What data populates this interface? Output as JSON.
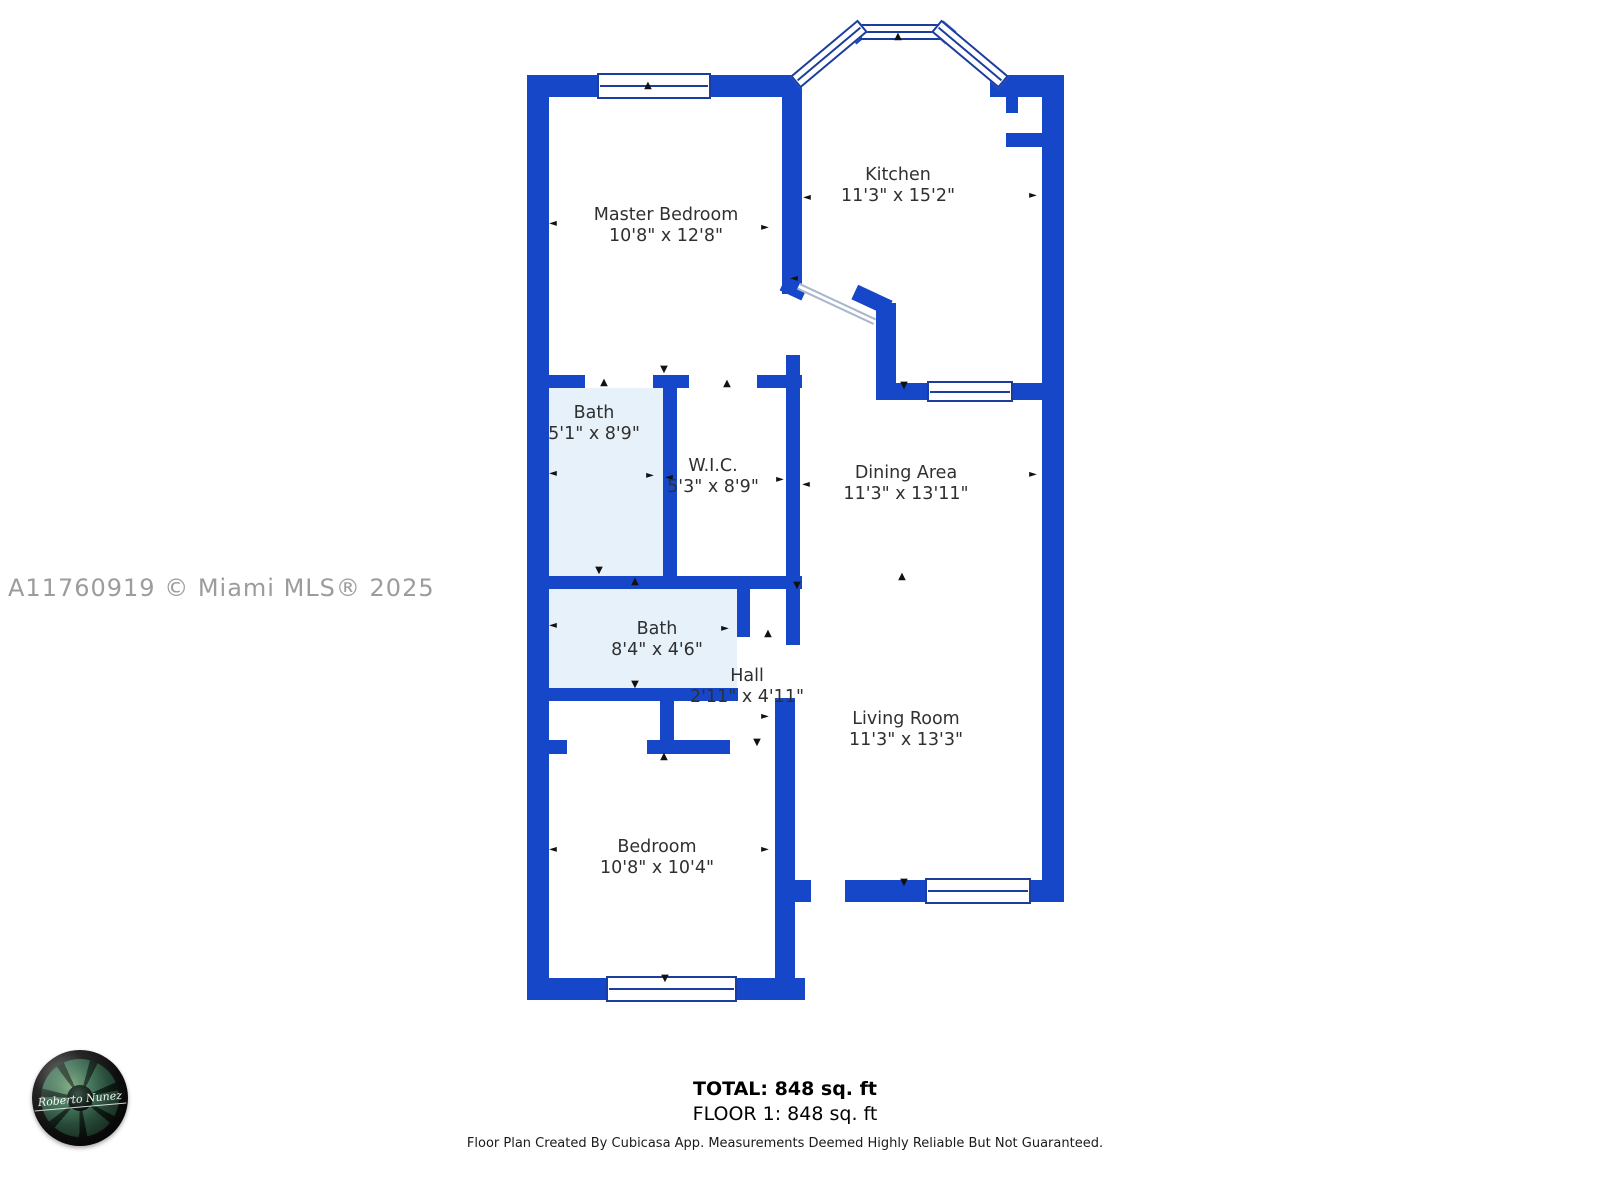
{
  "watermark": "A11760919 © Miami MLS® 2025",
  "rooms": [
    {
      "name": "Master Bedroom",
      "dims": "10'8\" x 12'8\""
    },
    {
      "name": "Kitchen",
      "dims": "11'3\" x 15'2\""
    },
    {
      "name": "Bath",
      "dims": "5'1\" x 8'9\""
    },
    {
      "name": "W.I.C.",
      "dims": "5'3\" x 8'9\""
    },
    {
      "name": "Dining Area",
      "dims": "11'3\" x 13'11\""
    },
    {
      "name": "Bath",
      "dims": "8'4\" x 4'6\""
    },
    {
      "name": "Hall",
      "dims": "2'11\" x 4'11\""
    },
    {
      "name": "Living Room",
      "dims": "11'3\" x 13'3\""
    },
    {
      "name": "Bedroom",
      "dims": "10'8\" x 10'4\""
    }
  ],
  "summary": {
    "total": "TOTAL: 848 sq. ft",
    "floor": "FLOOR 1: 848 sq. ft"
  },
  "disclaimer": "Floor Plan Created By Cubicasa App. Measurements Deemed Highly Reliable But Not Guaranteed.",
  "logo": {
    "signature": "Roberto Nunez"
  },
  "colors": {
    "wall": "#1647C9",
    "bath_fill": "#E6F1FA",
    "window_frame": "#1B3D9E",
    "separator_line": "#A9B6CC",
    "label_text": "#303030",
    "watermark_text": "#9C9C9C"
  }
}
